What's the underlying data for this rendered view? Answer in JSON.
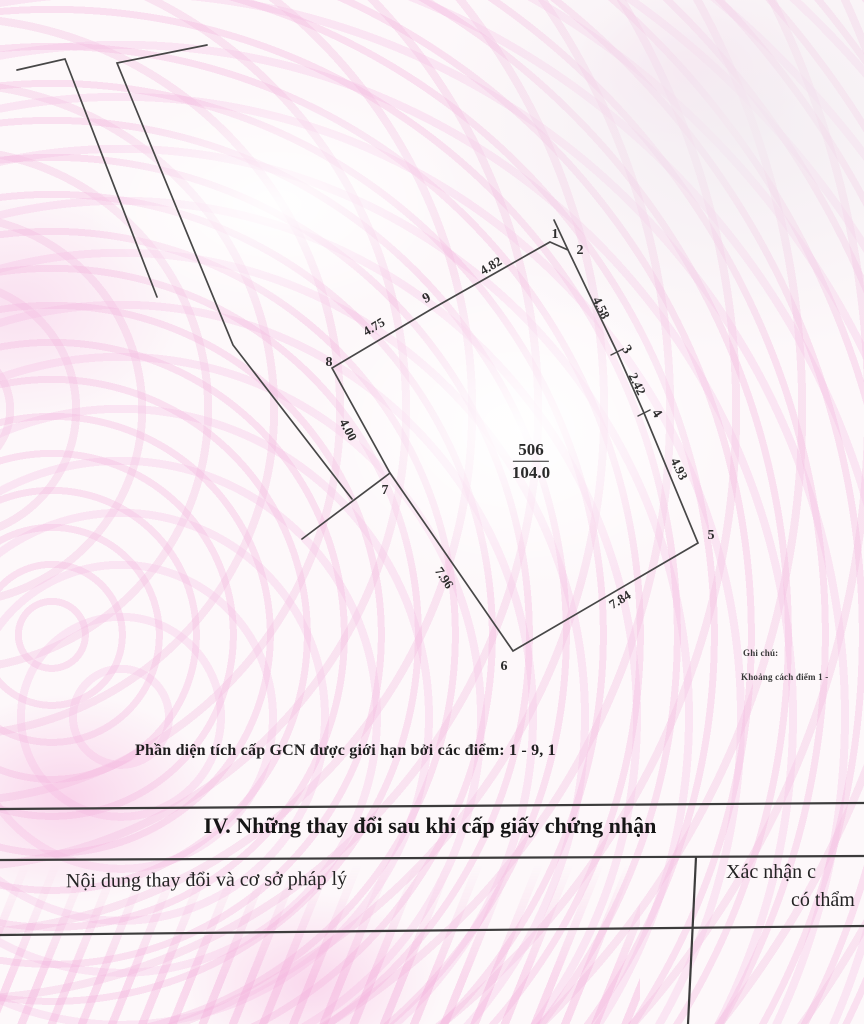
{
  "document": {
    "caption": "Phần diện tích cấp GCN được giới hạn bởi các điểm: 1 - 9, 1",
    "notes": {
      "line1": "Ghi chú:",
      "line2": "Khoảng cách điểm 1 -"
    }
  },
  "section4": {
    "title": "IV. Những thay đổi sau khi cấp giấy chứng nhận",
    "left_column_header": "Nội dung thay đổi và cơ sở pháp lý",
    "right_column_header_line1": "Xác nhận c",
    "right_column_header_line2": "có thẩm"
  },
  "diagram": {
    "parcel_number": "506",
    "parcel_area": "104.0",
    "boundary_point_range": "1 - 9, 1",
    "polygon": [
      [
        550,
        242
      ],
      [
        568,
        250
      ],
      [
        617,
        352
      ],
      [
        644,
        413
      ],
      [
        698,
        543
      ],
      [
        513,
        651
      ],
      [
        390,
        473
      ],
      [
        332,
        368
      ],
      [
        430,
        310
      ]
    ],
    "outer_lines": [
      [
        [
          17,
          70
        ],
        [
          65,
          59
        ],
        [
          157,
          297
        ]
      ],
      [
        [
          207,
          45
        ],
        [
          117,
          63
        ],
        [
          233,
          345
        ],
        [
          352,
          499
        ]
      ],
      [
        [
          390,
          473
        ],
        [
          302,
          539
        ]
      ],
      [
        [
          554,
          220
        ],
        [
          568,
          250
        ]
      ]
    ],
    "ticks": [
      [
        [
          611,
          355
        ],
        [
          623,
          349
        ]
      ],
      [
        [
          638,
          416
        ],
        [
          650,
          410
        ]
      ]
    ],
    "labels": [
      {
        "n": "vertex-1",
        "t": "1",
        "x": 555,
        "y": 235,
        "r": 0,
        "c": "v"
      },
      {
        "n": "vertex-2",
        "t": "2",
        "x": 580,
        "y": 251,
        "r": 0,
        "c": "v"
      },
      {
        "n": "vertex-3",
        "t": "3",
        "x": 626,
        "y": 350,
        "r": 55,
        "c": "v"
      },
      {
        "n": "vertex-4",
        "t": "4",
        "x": 656,
        "y": 414,
        "r": 55,
        "c": "v"
      },
      {
        "n": "vertex-5",
        "t": "5",
        "x": 711,
        "y": 536,
        "r": 0,
        "c": "v"
      },
      {
        "n": "vertex-6",
        "t": "6",
        "x": 504,
        "y": 667,
        "r": 0,
        "c": "v"
      },
      {
        "n": "vertex-7",
        "t": "7",
        "x": 385,
        "y": 491,
        "r": 0,
        "c": "v"
      },
      {
        "n": "vertex-8",
        "t": "8",
        "x": 329,
        "y": 363,
        "r": 0,
        "c": "v"
      },
      {
        "n": "vertex-9",
        "t": "9",
        "x": 427,
        "y": 299,
        "r": -28,
        "c": "v"
      },
      {
        "n": "edge-length-8-9",
        "t": "4.75",
        "x": 374,
        "y": 327,
        "r": -31,
        "c": "e"
      },
      {
        "n": "edge-length-9-1",
        "t": "4.82",
        "x": 491,
        "y": 266,
        "r": -31,
        "c": "e"
      },
      {
        "n": "edge-length-2-3",
        "t": "4.58",
        "x": 601,
        "y": 308,
        "r": 64,
        "c": "e"
      },
      {
        "n": "edge-length-3-4",
        "t": "2.42",
        "x": 637,
        "y": 384,
        "r": 64,
        "c": "e"
      },
      {
        "n": "edge-length-4-5",
        "t": "4.93",
        "x": 679,
        "y": 469,
        "r": 64,
        "c": "e"
      },
      {
        "n": "edge-length-8-7",
        "t": "4.00",
        "x": 348,
        "y": 430,
        "r": 62,
        "c": "e"
      },
      {
        "n": "edge-length-7-6",
        "t": "7.96",
        "x": 444,
        "y": 578,
        "r": 56,
        "c": "e"
      },
      {
        "n": "edge-length-6-5",
        "t": "7.84",
        "x": 620,
        "y": 600,
        "r": -32,
        "c": "e"
      }
    ]
  },
  "table_lines": [
    [
      [
        0,
        809
      ],
      [
        864,
        803
      ]
    ],
    [
      [
        0,
        860
      ],
      [
        864,
        856
      ]
    ],
    [
      [
        0,
        935
      ],
      [
        864,
        926
      ]
    ],
    [
      [
        696,
        857
      ],
      [
        688,
        1024
      ]
    ]
  ],
  "colors": {
    "ink": "#2d2d2d",
    "line": "#474747",
    "background_pink": "#f6b4de"
  }
}
